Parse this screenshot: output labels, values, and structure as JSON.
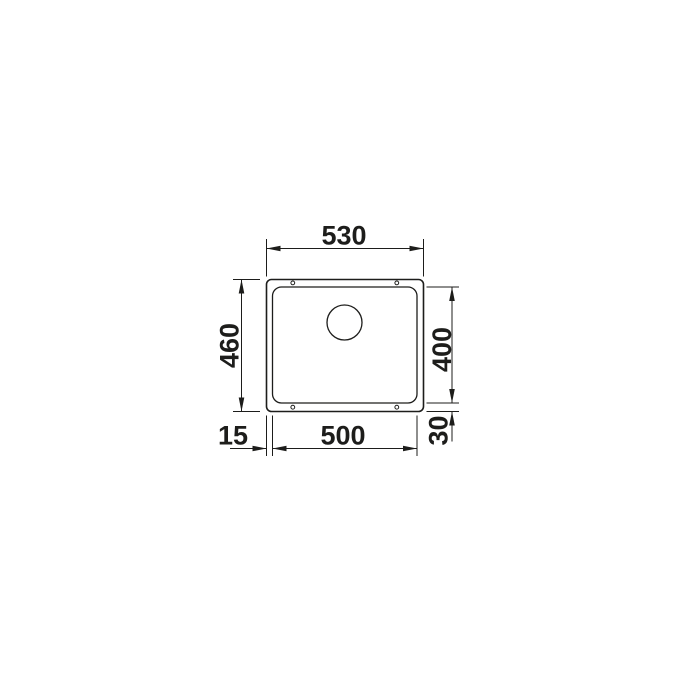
{
  "drawing": {
    "background_color": "#ffffff",
    "line_color": "#1d1d1b",
    "dimensions": {
      "overall_width": "530",
      "overall_depth": "460",
      "bowl_width": "500",
      "bowl_depth": "400",
      "rim_offset_left": "15",
      "rim_offset_bottom": "30"
    }
  }
}
